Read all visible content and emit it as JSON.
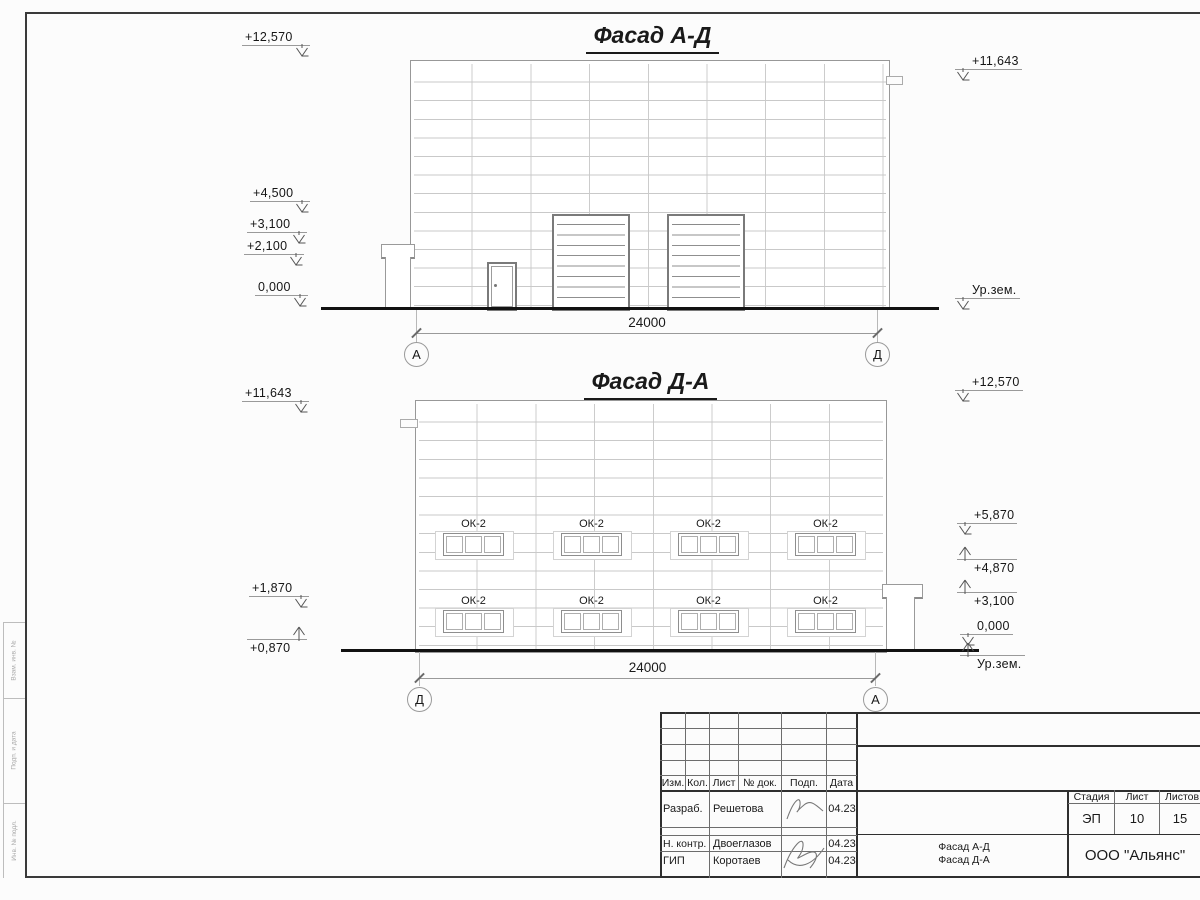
{
  "drawing": {
    "facade_top": {
      "title": "Фасад А-Д",
      "dimension": "24000",
      "axis_left": "А",
      "axis_right": "Д",
      "marks": {
        "m12570": "+12,570",
        "m4500": "+4,500",
        "m3100": "+3,100",
        "m2100": "+2,100",
        "m0000": "0,000",
        "m11643": "+11,643",
        "ground": "Ур.зем."
      }
    },
    "facade_bottom": {
      "title": "Фасад Д-А",
      "dimension": "24000",
      "axis_left": "Д",
      "axis_right": "А",
      "window_label": "ОК-2",
      "marks": {
        "m11643": "+11,643",
        "m1870": "+1,870",
        "m0870": "+0,870",
        "m12570": "+12,570",
        "m5870": "+5,870",
        "m4870": "+4,870",
        "m3100": "+3,100",
        "m0000": "0,000",
        "ground": "Ур.зем."
      }
    }
  },
  "title_block": {
    "cols": {
      "izm": "Изм.",
      "kol": "Кол.",
      "list": "Лист",
      "doc": "№ док.",
      "podp": "Подп.",
      "data": "Дата"
    },
    "rows": [
      {
        "role": "Разраб.",
        "name": "Решетова",
        "date": "04.23"
      },
      {
        "role": "Н. контр.",
        "name": "Двоеглазов",
        "date": "04.23"
      },
      {
        "role": "ГИП",
        "name": "Коротаев",
        "date": "04.23"
      }
    ],
    "stage": {
      "h1": "Стадия",
      "h2": "Лист",
      "h3": "Листов",
      "v1": "ЭП",
      "v2": "10",
      "v3": "15"
    },
    "sheet_name": {
      "line1": "Фасад А-Д",
      "line2": "Фасад Д-А"
    },
    "company": "ООО \"Альянс\""
  },
  "margin_labels": [
    "Взам. инв. №",
    "Подп. и дата",
    "Инв. № подл."
  ]
}
